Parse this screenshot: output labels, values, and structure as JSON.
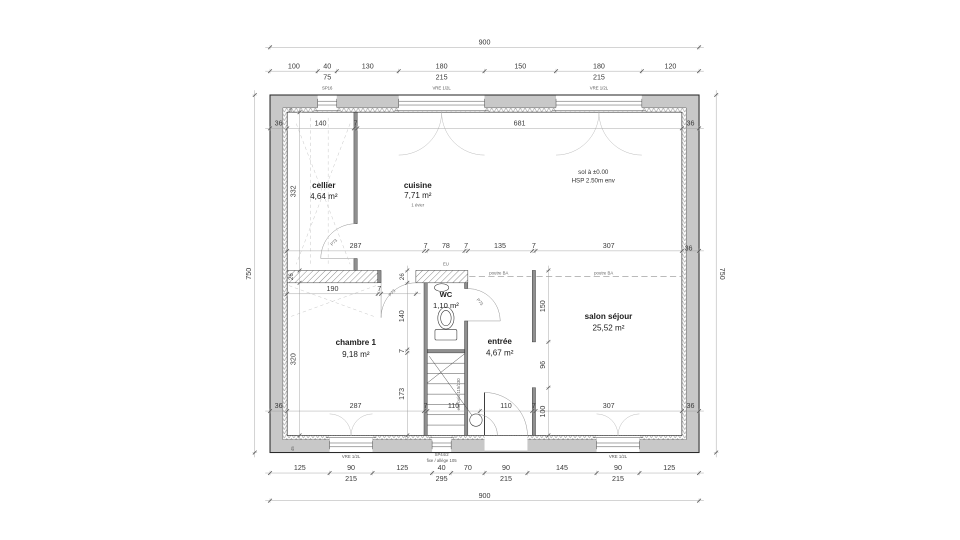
{
  "overall": {
    "width": "900",
    "height": "750"
  },
  "rooms": {
    "cellier": {
      "name": "cellier",
      "area": "4,64 m²"
    },
    "cuisine": {
      "name": "cuisine",
      "area": "7,71 m²",
      "note": "1 évier"
    },
    "wc": {
      "name": "WC",
      "area": "1,10 m²"
    },
    "chambre": {
      "name": "chambre 1",
      "area": "9,18 m²"
    },
    "entree": {
      "name": "entrée",
      "area": "4,67 m²"
    },
    "salon": {
      "name": "salon séjour",
      "area": "25,52 m²"
    }
  },
  "annotations": {
    "floor_level": "sol à ±0.00",
    "ceiling_height": "HSP 2.50m env",
    "beam": "poutre BA",
    "drain": "EU",
    "stair": "esc bois 115/230",
    "door_tag": "P73",
    "corner_tag": "45"
  },
  "openings": {
    "top": [
      {
        "label": "SP16"
      },
      {
        "label": "VRE 1/2L"
      },
      {
        "label": "VRE 1/2L"
      }
    ],
    "bottom": [
      {
        "label": "VRE 1/2L"
      },
      {
        "label": "SP44/2",
        "sub": "fixe / allège 105"
      },
      {
        "label": "VRE 1/2L"
      }
    ]
  },
  "dims": {
    "top_row": [
      {
        "a": "100"
      },
      {
        "a": "40",
        "b": "75"
      },
      {
        "a": "130"
      },
      {
        "a": "180",
        "b": "215"
      },
      {
        "a": "150"
      },
      {
        "a": "180",
        "b": "215"
      },
      {
        "a": "120"
      }
    ],
    "bottom_row": [
      {
        "a": "125"
      },
      {
        "a": "90",
        "b": "215"
      },
      {
        "a": "125"
      },
      {
        "a": "40",
        "b": "295"
      },
      {
        "a": "70"
      },
      {
        "a": "90",
        "b": "215"
      },
      {
        "a": "145"
      },
      {
        "a": "90",
        "b": "215"
      },
      {
        "a": "125"
      }
    ],
    "top_inner": [
      "36",
      "140",
      "7",
      "681",
      "36"
    ],
    "mid_row": [
      "287",
      "7",
      "78",
      "7",
      "135",
      "7",
      "307"
    ],
    "mid_right": "36",
    "bottom_inner": [
      "36",
      "287",
      "7",
      "110",
      "110",
      "7",
      "307",
      "36"
    ],
    "chambre_top": [
      "190",
      "7"
    ],
    "left_col": {
      "cellier": "332",
      "band": "26",
      "chambre": "320"
    },
    "wc_col": {
      "band": "26",
      "wc": "140",
      "wall": "7",
      "stair": "173"
    },
    "salon_col": [
      "150",
      "96",
      "100"
    ]
  }
}
